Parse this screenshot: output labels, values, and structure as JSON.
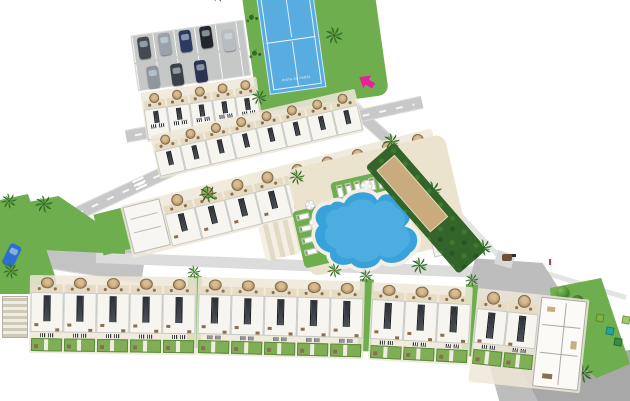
{
  "plan": {
    "padel_court": {
      "label": "PISTA DE PADEL"
    },
    "blocks": {
      "top_row": {
        "units": 5
      },
      "upper_middle": {
        "units": 8
      },
      "lower_middle": {
        "units": 9
      },
      "bottom": [
        {
          "units": 5
        },
        {
          "units": 5
        },
        {
          "units": 3
        },
        {
          "units": 2
        }
      ]
    },
    "parking": {
      "car_count": 8
    },
    "cars": [
      {
        "css": "background:#454a52"
      },
      {
        "css": "background:#9aa1a8"
      },
      {
        "css": "background:#2c3a5f"
      },
      {
        "css": "background:#23272d"
      },
      {
        "css": "background:#8f969e"
      },
      {
        "css": "background:#3c4148"
      },
      {
        "css": "background:#2a3350"
      },
      {
        "css": "background:#b9bdc2"
      }
    ],
    "street_car": {
      "css": "background:#2b6fd4"
    },
    "planters": [
      {
        "css": "background:#7cb342"
      },
      {
        "css": "background:#26a69a"
      },
      {
        "css": "background:#388e3c"
      },
      {
        "css": "background:#9ccc65"
      }
    ],
    "colors": {
      "background": "#ffffff",
      "lawn": "#6fae4e",
      "hedge": "#33642a",
      "road": "#c8c8c8",
      "plaza": "#a8a8a8",
      "deck": "#ece3cf",
      "terrace": "#e6dcc4",
      "roof": "#f6f5f0",
      "solar_panel": "#31363b",
      "umbrella": "#c3a377",
      "pool": "#3aa2da",
      "padel_court": "#58ace0",
      "petanque_sand": "#c9ab7d",
      "entrance_arrow": "#e8219a"
    }
  }
}
